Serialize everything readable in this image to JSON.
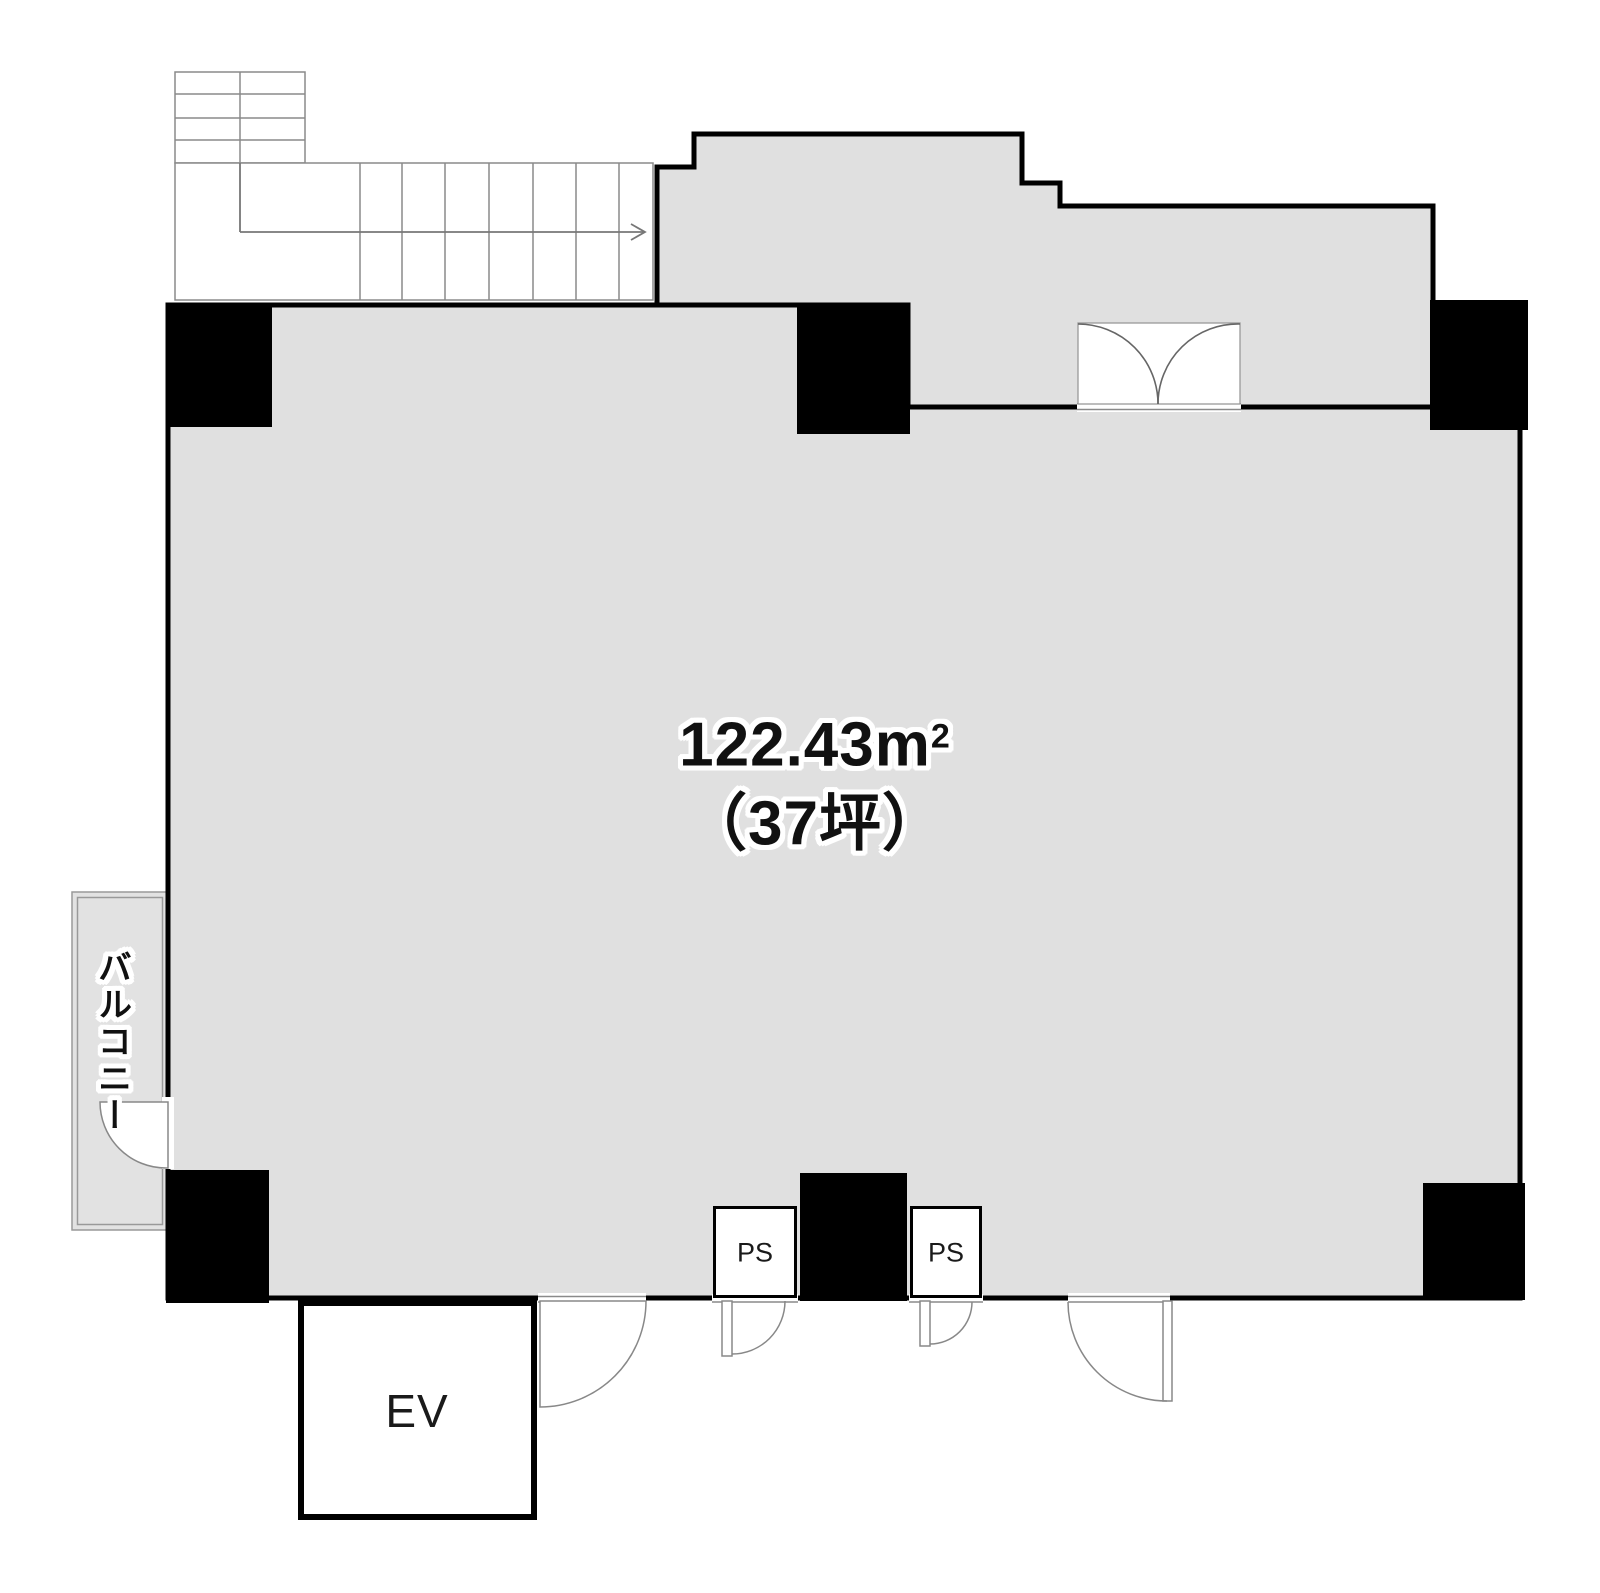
{
  "floor_plan": {
    "area": {
      "value": "122.43m",
      "superscript": "2",
      "tsubo": "（37坪）"
    },
    "balcony": {
      "label": "バルコニー"
    },
    "elevator": {
      "label": "EV"
    },
    "pipe_shafts": [
      {
        "label": "PS"
      },
      {
        "label": "PS"
      }
    ],
    "colors": {
      "floor": "#e0e0e0",
      "wall": "#000000",
      "background": "#ffffff",
      "thin_line": "#8a8a8a"
    }
  }
}
